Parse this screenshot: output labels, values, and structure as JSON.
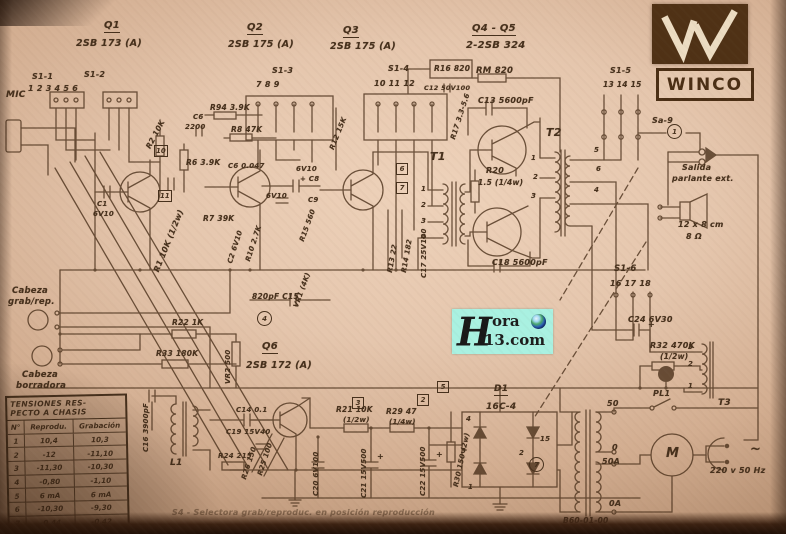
{
  "logo": {
    "name": "WINCO"
  },
  "watermark": {
    "h": "H",
    "top": "ora",
    "bottom": "13.com"
  },
  "colors": {
    "ink": "#4e341e",
    "paper": "#e5c6ad",
    "logo_brown": "#4f3115",
    "watermark_bg": "#a9f1e1"
  },
  "table": {
    "title1": "TENSIONES RES-",
    "title2": "PECTO A CHASIS",
    "headers": [
      "N°",
      "Reprodu.",
      "Grabación"
    ],
    "rows": [
      [
        "1",
        "10,4",
        "10,3"
      ],
      [
        "2",
        "-12",
        "-11,10"
      ],
      [
        "3",
        "-11,30",
        "-10,30"
      ],
      [
        "4",
        "-0,80",
        "-1,10"
      ],
      [
        "5",
        "6 mA",
        "6 mA"
      ],
      [
        "6",
        "-10,30",
        "-9,30"
      ],
      [
        "7",
        "-0,44",
        "-0,42"
      ],
      [
        "8",
        "-6,10",
        "-5,40"
      ],
      [
        "9",
        "-5,84",
        "-3,40"
      ]
    ]
  },
  "schematic": {
    "labels": [
      {
        "t": "Q1",
        "x": 104,
        "y": 20,
        "s": 10,
        "u": 1
      },
      {
        "t": "2SB 173 (A)",
        "x": 76,
        "y": 38,
        "s": 9.5
      },
      {
        "t": "Q2",
        "x": 247,
        "y": 22,
        "s": 10,
        "u": 1
      },
      {
        "t": "2SB 175 (A)",
        "x": 228,
        "y": 39,
        "s": 9.5
      },
      {
        "t": "Q3",
        "x": 343,
        "y": 25,
        "s": 10,
        "u": 1
      },
      {
        "t": "2SB 175 (A)",
        "x": 330,
        "y": 41,
        "s": 9.5
      },
      {
        "t": "Q4 - Q5",
        "x": 472,
        "y": 23,
        "s": 10,
        "u": 1
      },
      {
        "t": "2-2SB 324",
        "x": 466,
        "y": 40,
        "s": 10
      },
      {
        "t": "S1-1",
        "x": 32,
        "y": 72,
        "s": 8
      },
      {
        "t": "S1-2",
        "x": 84,
        "y": 70,
        "s": 8
      },
      {
        "t": "1 2 3 4 5 6",
        "x": 28,
        "y": 84,
        "s": 8
      },
      {
        "t": "S1-3",
        "x": 272,
        "y": 66,
        "s": 8
      },
      {
        "t": "7 8 9",
        "x": 256,
        "y": 80,
        "s": 8
      },
      {
        "t": "S1-4",
        "x": 388,
        "y": 64,
        "s": 8
      },
      {
        "t": "10 11 12",
        "x": 374,
        "y": 79,
        "s": 8
      },
      {
        "t": "S1-5",
        "x": 610,
        "y": 66,
        "s": 8
      },
      {
        "t": "13 14 15",
        "x": 603,
        "y": 80,
        "s": 7.5
      },
      {
        "t": "S1-6",
        "x": 614,
        "y": 264,
        "s": 8.5
      },
      {
        "t": "16 17 18",
        "x": 610,
        "y": 279,
        "s": 8
      },
      {
        "t": "Sa-9",
        "x": 652,
        "y": 116,
        "s": 8
      },
      {
        "t": "MIC",
        "x": 6,
        "y": 90,
        "s": 9
      },
      {
        "t": "R1 10K (1/2w)",
        "x": 152,
        "y": 270,
        "r": -68,
        "s": 8
      },
      {
        "t": "R2 10K",
        "x": 144,
        "y": 146,
        "r": -62,
        "s": 7.5
      },
      {
        "t": "Cabeza",
        "x": 12,
        "y": 286,
        "s": 8.5
      },
      {
        "t": "grab/rep.",
        "x": 8,
        "y": 297,
        "s": 8.5
      },
      {
        "t": "Cabeza",
        "x": 22,
        "y": 370,
        "s": 8.5
      },
      {
        "t": "borradora",
        "x": 16,
        "y": 381,
        "s": 8.5
      },
      {
        "t": "C1",
        "x": 97,
        "y": 200,
        "s": 7
      },
      {
        "t": "6V10",
        "x": 93,
        "y": 210,
        "s": 7
      },
      {
        "t": "R94 3.9K",
        "x": 210,
        "y": 103,
        "s": 7.5
      },
      {
        "t": "C6",
        "x": 193,
        "y": 113,
        "s": 7
      },
      {
        "t": "2200",
        "x": 185,
        "y": 123,
        "s": 7
      },
      {
        "t": "R8 47K",
        "x": 231,
        "y": 125,
        "s": 7.5
      },
      {
        "t": "R6 3.9K",
        "x": 186,
        "y": 158,
        "s": 7.5
      },
      {
        "t": "C6 0.047",
        "x": 228,
        "y": 162,
        "s": 7
      },
      {
        "t": "6V10",
        "x": 296,
        "y": 165,
        "s": 7
      },
      {
        "t": "+ C8",
        "x": 300,
        "y": 175,
        "s": 7
      },
      {
        "t": "6V10",
        "x": 266,
        "y": 192,
        "s": 7
      },
      {
        "t": "C9",
        "x": 308,
        "y": 196,
        "s": 7
      },
      {
        "t": "R7 39K",
        "x": 203,
        "y": 214,
        "s": 7.5
      },
      {
        "t": "C2 6V10",
        "x": 226,
        "y": 262,
        "r": -72,
        "s": 7
      },
      {
        "t": "R10 2.7K",
        "x": 244,
        "y": 260,
        "r": -72,
        "s": 7
      },
      {
        "t": "R12 15K",
        "x": 328,
        "y": 148,
        "r": -68,
        "s": 7
      },
      {
        "t": "R13 22",
        "x": 386,
        "y": 272,
        "r": -80,
        "s": 7
      },
      {
        "t": "R14 182",
        "x": 400,
        "y": 272,
        "r": -80,
        "s": 7
      },
      {
        "t": "C17 25V100",
        "x": 420,
        "y": 278,
        "r": -90,
        "s": 7
      },
      {
        "t": "VR1 (4K)",
        "x": 292,
        "y": 306,
        "r": -70,
        "s": 7
      },
      {
        "t": "R15 560",
        "x": 298,
        "y": 240,
        "r": -70,
        "s": 7
      },
      {
        "t": "R16 820",
        "x": 434,
        "y": 64,
        "s": 7.5
      },
      {
        "t": "C12 50V100",
        "x": 424,
        "y": 84,
        "s": 6.5
      },
      {
        "t": "RM 820",
        "x": 476,
        "y": 66,
        "s": 8.5
      },
      {
        "t": "C13 5600pF",
        "x": 478,
        "y": 96,
        "s": 8
      },
      {
        "t": "R17 3.3-5.6",
        "x": 449,
        "y": 138,
        "r": -72,
        "s": 7
      },
      {
        "t": "T1",
        "x": 430,
        "y": 150,
        "s": 11
      },
      {
        "t": "T2",
        "x": 546,
        "y": 126,
        "s": 11
      },
      {
        "t": "R20",
        "x": 486,
        "y": 166,
        "s": 8
      },
      {
        "t": "1.5 (1/4w)",
        "x": 478,
        "y": 178,
        "s": 7.5
      },
      {
        "t": "C18 5600pF",
        "x": 492,
        "y": 258,
        "s": 8
      },
      {
        "t": "1",
        "x": 421,
        "y": 185,
        "s": 7
      },
      {
        "t": "2",
        "x": 421,
        "y": 201,
        "s": 7
      },
      {
        "t": "3",
        "x": 421,
        "y": 217,
        "s": 7
      },
      {
        "t": "4",
        "x": 421,
        "y": 233,
        "s": 7
      },
      {
        "t": "1",
        "x": 531,
        "y": 154,
        "s": 7
      },
      {
        "t": "2",
        "x": 533,
        "y": 173,
        "s": 7
      },
      {
        "t": "3",
        "x": 531,
        "y": 192,
        "s": 7
      },
      {
        "t": "5",
        "x": 594,
        "y": 146,
        "s": 7
      },
      {
        "t": "6",
        "x": 596,
        "y": 165,
        "s": 7
      },
      {
        "t": "4",
        "x": 594,
        "y": 186,
        "s": 7
      },
      {
        "t": "Salida",
        "x": 682,
        "y": 163,
        "s": 8
      },
      {
        "t": "parlante ext.",
        "x": 672,
        "y": 174,
        "s": 8
      },
      {
        "t": "12 x 8 cm",
        "x": 678,
        "y": 220,
        "s": 8
      },
      {
        "t": "8 Ω",
        "x": 686,
        "y": 232,
        "s": 8
      },
      {
        "t": "C24 6V30",
        "x": 628,
        "y": 315,
        "s": 8
      },
      {
        "t": "R32 470K",
        "x": 650,
        "y": 341,
        "s": 8
      },
      {
        "t": "(1/2w)",
        "x": 660,
        "y": 352,
        "s": 7.5
      },
      {
        "t": "PL1",
        "x": 653,
        "y": 389,
        "s": 8
      },
      {
        "t": "T3",
        "x": 718,
        "y": 398,
        "s": 9
      },
      {
        "t": "3",
        "x": 688,
        "y": 343,
        "s": 7
      },
      {
        "t": "2",
        "x": 688,
        "y": 360,
        "s": 7
      },
      {
        "t": "1",
        "x": 688,
        "y": 382,
        "s": 7
      },
      {
        "t": "50",
        "x": 607,
        "y": 399,
        "s": 8
      },
      {
        "t": "0",
        "x": 612,
        "y": 443,
        "s": 8
      },
      {
        "t": "50A",
        "x": 602,
        "y": 457,
        "s": 8
      },
      {
        "t": "0A",
        "x": 609,
        "y": 499,
        "s": 8
      },
      {
        "t": "B60-01-00",
        "x": 563,
        "y": 516,
        "s": 7.5
      },
      {
        "t": "M",
        "x": 666,
        "y": 446,
        "s": 13
      },
      {
        "t": "220 v 50 Hz",
        "x": 710,
        "y": 466,
        "s": 8
      },
      {
        "t": "~",
        "x": 750,
        "y": 442,
        "s": 13
      },
      {
        "t": "D1",
        "x": 494,
        "y": 384,
        "s": 9,
        "u": 1
      },
      {
        "t": "16C-4",
        "x": 486,
        "y": 402,
        "s": 9
      },
      {
        "t": "4",
        "x": 466,
        "y": 415,
        "s": 7
      },
      {
        "t": "3",
        "x": 461,
        "y": 447,
        "s": 7
      },
      {
        "t": "2",
        "x": 519,
        "y": 449,
        "s": 7
      },
      {
        "t": "1",
        "x": 468,
        "y": 483,
        "s": 7
      },
      {
        "t": "15",
        "x": 540,
        "y": 435,
        "s": 7
      },
      {
        "t": "R21 10K",
        "x": 336,
        "y": 405,
        "s": 7.5
      },
      {
        "t": "(1/2w)",
        "x": 343,
        "y": 416,
        "s": 7
      },
      {
        "t": "R29 47",
        "x": 386,
        "y": 407,
        "s": 7.5
      },
      {
        "t": "(1/4w)",
        "x": 389,
        "y": 418,
        "s": 7
      },
      {
        "t": "C21 15V500",
        "x": 360,
        "y": 498,
        "r": -90,
        "s": 7
      },
      {
        "t": "C22 15V500",
        "x": 419,
        "y": 496,
        "r": -90,
        "s": 7
      },
      {
        "t": "R30 150 (2w)",
        "x": 452,
        "y": 486,
        "r": -78,
        "s": 7
      },
      {
        "t": "+",
        "x": 377,
        "y": 452,
        "s": 8
      },
      {
        "t": "+",
        "x": 436,
        "y": 450,
        "s": 8
      },
      {
        "t": "+",
        "x": 648,
        "y": 320,
        "s": 8
      },
      {
        "t": "Q6",
        "x": 262,
        "y": 341,
        "s": 10,
        "u": 1
      },
      {
        "t": "2SB 172 (A)",
        "x": 246,
        "y": 360,
        "s": 9.5
      },
      {
        "t": "R22 1K",
        "x": 172,
        "y": 318,
        "s": 7.5
      },
      {
        "t": "R33 180K",
        "x": 156,
        "y": 349,
        "s": 7.5
      },
      {
        "t": "VR2 500",
        "x": 224,
        "y": 384,
        "r": -90,
        "s": 7
      },
      {
        "t": "820pF C15",
        "x": 252,
        "y": 292,
        "s": 7.5
      },
      {
        "t": "C16 3900pF",
        "x": 142,
        "y": 452,
        "r": -90,
        "s": 7
      },
      {
        "t": "L1",
        "x": 170,
        "y": 458,
        "s": 9
      },
      {
        "t": "C14 0.1",
        "x": 236,
        "y": 406,
        "s": 7
      },
      {
        "t": "C19 15V40",
        "x": 226,
        "y": 428,
        "s": 7
      },
      {
        "t": "R24 215",
        "x": 218,
        "y": 452,
        "s": 7
      },
      {
        "t": "R25 100",
        "x": 256,
        "y": 474,
        "r": -72,
        "s": 7
      },
      {
        "t": "R26 150",
        "x": 240,
        "y": 478,
        "r": -72,
        "s": 7
      },
      {
        "t": "C20 6V100",
        "x": 312,
        "y": 496,
        "r": -90,
        "s": 7
      },
      {
        "t": "S4 - Selectora grab/reproduc. en posición reproducción",
        "x": 172,
        "y": 508,
        "s": 8,
        "f": 1
      }
    ],
    "marks": [
      {
        "n": "1",
        "x": 667,
        "y": 124,
        "shape": "circle"
      },
      {
        "n": "4",
        "x": 257,
        "y": 311,
        "shape": "circle"
      },
      {
        "n": "7",
        "x": 529,
        "y": 457,
        "shape": "circle"
      },
      {
        "n": "10",
        "x": 154,
        "y": 145,
        "shape": "box"
      },
      {
        "n": "11",
        "x": 158,
        "y": 190,
        "shape": "box"
      },
      {
        "n": "6",
        "x": 396,
        "y": 163,
        "shape": "box"
      },
      {
        "n": "7",
        "x": 396,
        "y": 182,
        "shape": "box"
      },
      {
        "n": "5",
        "x": 437,
        "y": 381,
        "shape": "box"
      },
      {
        "n": "2",
        "x": 417,
        "y": 394,
        "shape": "box"
      },
      {
        "n": "3",
        "x": 352,
        "y": 397,
        "shape": "box"
      }
    ]
  }
}
